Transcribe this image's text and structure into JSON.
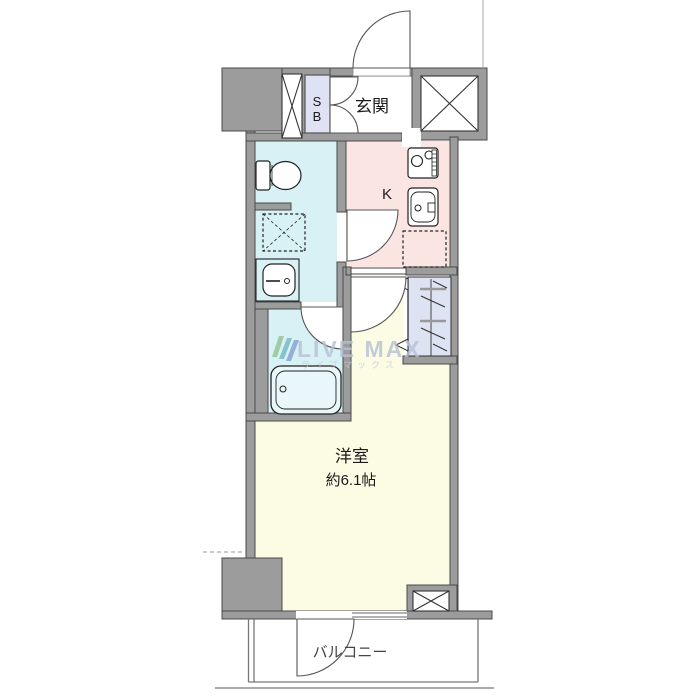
{
  "page": {
    "width": 700,
    "height": 700,
    "background": "#ffffff",
    "type": "apartment-floor-plan"
  },
  "plan": {
    "labels": {
      "genkan": "玄関",
      "shoe_box_line1": "S",
      "shoe_box_line2": "B",
      "kitchen": "K",
      "main_room_name": "洋室",
      "main_room_size": "約6.1帖",
      "balcony": "バルコニー"
    },
    "rooms": [
      {
        "name": "entrance",
        "label": "玄関"
      },
      {
        "name": "shoe-box",
        "label": "SB"
      },
      {
        "name": "kitchen",
        "label": "K"
      },
      {
        "name": "toilet-laundry-washroom",
        "label": ""
      },
      {
        "name": "bathroom",
        "label": ""
      },
      {
        "name": "closet",
        "label": ""
      },
      {
        "name": "western-room",
        "label": "洋室 約6.1帖"
      },
      {
        "name": "balcony",
        "label": "バルコニー"
      }
    ],
    "colors": {
      "wall": "#9c9c9c",
      "wall_outline": "#4a4a4a",
      "sanitary": "#d7f1f5",
      "kitchen": "#fbe5e2",
      "shoe_box": "#dfe2f4",
      "closet": "#dde3f2",
      "main_room": "#fcfce4",
      "tub_fill": "#e9f7fa",
      "white": "#ffffff",
      "label_text": "#1a1a1a",
      "door_line": "#555555",
      "balcony_line": "#777777"
    }
  },
  "watermark": {
    "text": "LIVE MAX",
    "subtext": "ライブマックス",
    "text_color": "#b6c0d5",
    "subtext_color": "#c6c9d2",
    "logo_color_1": "#6fae67",
    "logo_color_2": "#46a0ad",
    "logo_color_3": "#5d7fc0"
  }
}
